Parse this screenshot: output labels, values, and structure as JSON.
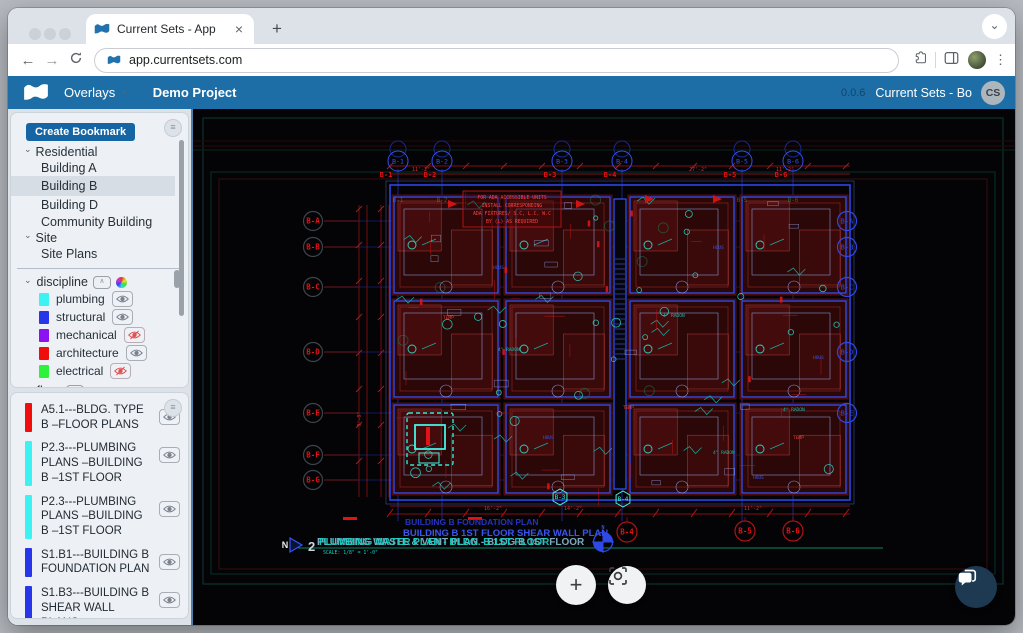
{
  "browser": {
    "tab_title": "Current Sets - App",
    "url": "app.currentsets.com"
  },
  "icons": {
    "chevron_down": "⌄",
    "menu": "≡",
    "close": "×",
    "new_tab": "+",
    "back": "←",
    "forward": "→",
    "kebab": "⋮",
    "collapse": "∧",
    "plus": "+"
  },
  "header": {
    "nav_overlays": "Overlays",
    "project": "Demo Project",
    "version": "0.0.6",
    "account": "Current Sets - Bo",
    "avatar_initials": "CS",
    "accent_color": "#1d6ea7"
  },
  "sidebar": {
    "create_bookmark": "Create Bookmark",
    "tree": [
      {
        "label": "Residential"
      },
      {
        "label": "Building A"
      },
      {
        "label": "Building B"
      },
      {
        "label": "Building D"
      },
      {
        "label": "Community Building"
      },
      {
        "label": "Site"
      },
      {
        "label": "Site Plans"
      }
    ],
    "discipline_label": "discipline",
    "discipline": {
      "items": [
        {
          "label": "plumbing",
          "color": "#3df2f2",
          "visible": true
        },
        {
          "label": "structural",
          "color": "#2636e8",
          "visible": true
        },
        {
          "label": "mechanical",
          "color": "#8d12f2",
          "visible": false
        },
        {
          "label": "architecture",
          "color": "#f20d0d",
          "visible": true
        },
        {
          "label": "electrical",
          "color": "#2df23c",
          "visible": false
        }
      ]
    },
    "floor_label": "floor",
    "sheets": [
      {
        "label": "A5.1---BLDG. TYPE B –FLOOR PLANS",
        "color": "#f20d0d",
        "visible": true
      },
      {
        "label": "P2.3---PLUMBING PLANS –BUILDING B –1ST FLOOR",
        "color": "#3df2f2",
        "visible": true
      },
      {
        "label": "P2.3---PLUMBING PLANS –BUILDING B –1ST FLOOR",
        "color": "#3df2f2",
        "visible": true
      },
      {
        "label": "S1.B1---BUILDING B FOUNDATION PLAN",
        "color": "#2636e8",
        "visible": true
      },
      {
        "label": "S1.B3---BUILDING B SHEAR WALL PLANS",
        "color": "#2636e8",
        "visible": true
      }
    ]
  },
  "canvas": {
    "grid_labels": {
      "top": [
        "B-1",
        "B-2",
        "B-3",
        "B-4",
        "B-5",
        "B-6"
      ],
      "left": [
        "B-A",
        "B-B",
        "B-C",
        "B-D",
        "B-E",
        "B-F",
        "B-G"
      ],
      "right": [
        "B-A",
        "B-B",
        "B-C",
        "B-D",
        "B-E"
      ],
      "bottom": [
        "B-4",
        "B-5",
        "B-6"
      ],
      "bottom_cyan": [
        "B-3",
        "B-4"
      ]
    },
    "note_box_lines": [
      "FOR ADA ACCESSIBLE UNITS",
      "INSTALL CORRESPONDING",
      "ADA FIXTURES/ S.C, L.C, W.C",
      "BY (L) AS REQUIRED"
    ],
    "dim_labels": [
      "11'-2\"",
      "27'-2\"",
      "11'-2\"",
      "14'-2\"",
      "16'-2\"",
      "11'-2\"",
      "9'-9\""
    ],
    "small_labels": {
      "radon": "4\" RADON",
      "hous": "HOUS",
      "temp": "TEMP",
      "north": "N"
    },
    "titles": {
      "detail_number": "2",
      "foundation": "BUILDING B FOUNDATION PLAN",
      "shear": "BUILDING B 1ST FLOOR SHEAR WALL PLAN",
      "plumbing_waste": "PLUMBING WASTE & VENT PLAN - BLDG B 1ST FLOOR",
      "plumbing_water": "PLUMBING WATER PLAN - BLDG. B 1ST FLOOR",
      "scale": "SCALE: 1/8\" = 1'-0\""
    },
    "colors": {
      "plumbing_cyan": "#2fe8d8",
      "structural_blue": "#3353ff",
      "architecture_red": "#8f1a1a",
      "grid_blue": "#1f2fae",
      "dim_red": "#c01414"
    }
  }
}
